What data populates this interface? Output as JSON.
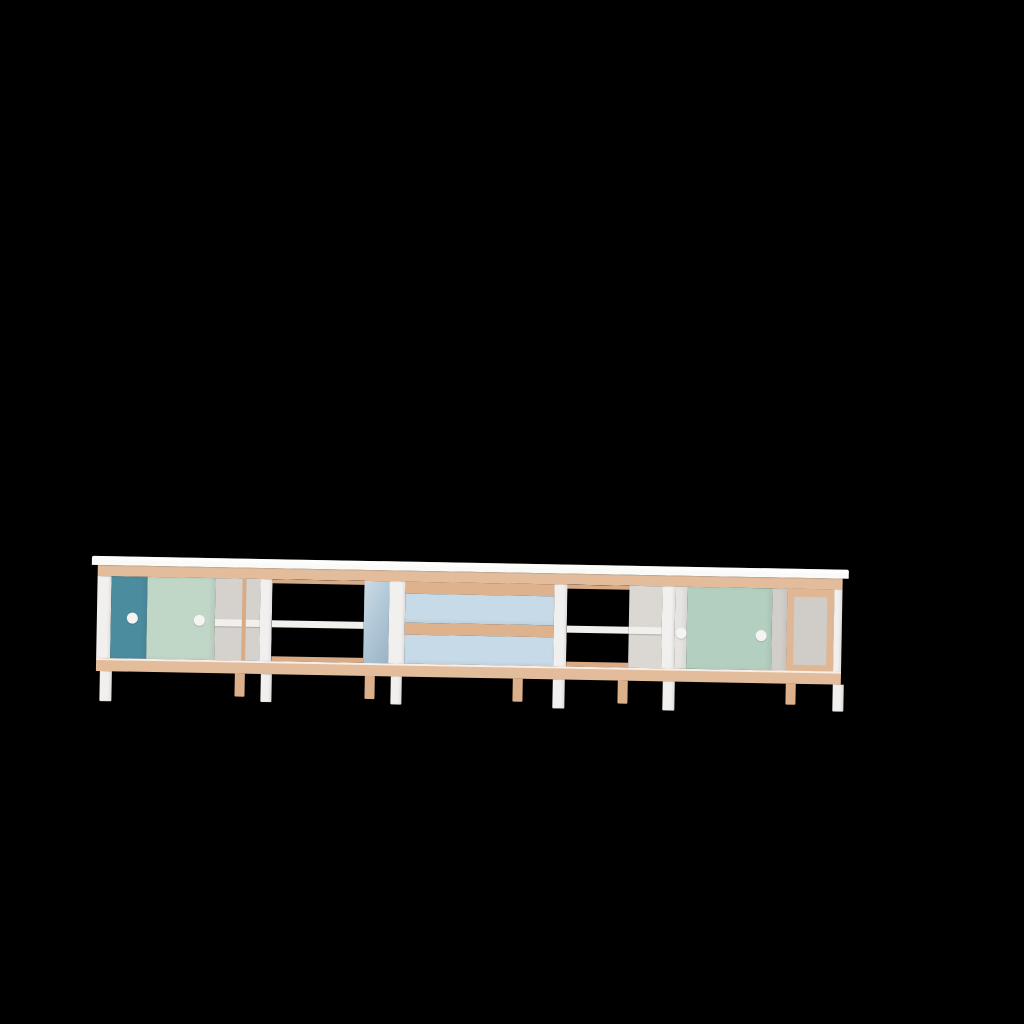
{
  "scene": {
    "background_color": "#000000",
    "kind": "3D product render",
    "description": "Long low Scandinavian-style modular sideboard viewed straight on against a black background; white frame with pale wood rails and legs, sliding doors in teal and mint, two light-blue drawers and open shelf bays"
  },
  "furniture": {
    "name": "modular sideboard",
    "frame": {
      "white": "#f2f0ee",
      "white_bright": "#fafaf8",
      "wood": "#e3bc9b",
      "wood_dark": "#d8ab87",
      "wood_lip": "#dfb28e",
      "wood_leg": "#ddb08c"
    },
    "left_cabinet": {
      "teal_door": "#4c8c9f",
      "mint_door": "#c0d6c6",
      "interior_back": "#d5d2ce",
      "handle": "#f6f4f2"
    },
    "open_bay_left": {
      "shelf": "#f2f0ed",
      "open_background": "#000000"
    },
    "drawer_unit": {
      "side_panel": "#a2bdd0",
      "drawer_face": "#c7dae7",
      "lip": "#dfb28e"
    },
    "open_bay_right": {
      "shelf": "#f2f0ed",
      "back_panel": "#dbd8d4"
    },
    "right_cabinet": {
      "white_door": "#e6e4e1",
      "mint_door": "#b3cfc0",
      "grey_door": "#d2cfcb",
      "handle": "#f6f4f2"
    },
    "end_module": {
      "panel": "#d0cdc9",
      "frame_wood": "#e0b795"
    }
  }
}
